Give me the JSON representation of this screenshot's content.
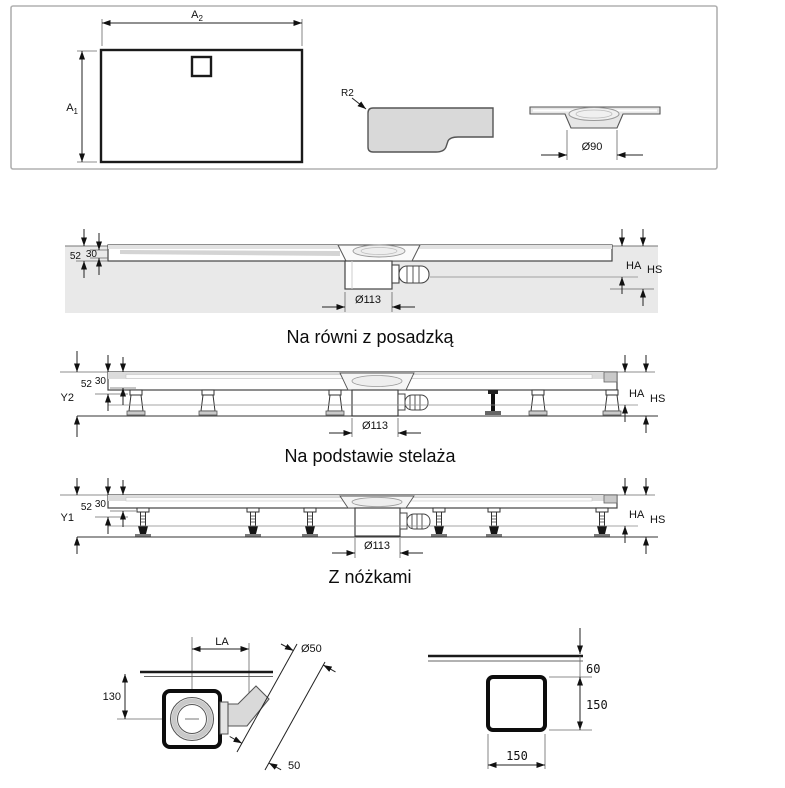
{
  "top": {
    "plan": {
      "w_base": "A",
      "w_sub": "2",
      "h_base": "A",
      "h_sub": "1"
    },
    "profile": {
      "r": "R2"
    },
    "drain": {
      "dia": "Ø90"
    }
  },
  "s1": {
    "title": "Na równi z posadzką",
    "d52": "52",
    "d30": "30",
    "ha": "HA",
    "hs": "HS",
    "dia": "Ø113"
  },
  "s2": {
    "title": "Na podstawie stelaża",
    "y": "Y2",
    "d52": "52",
    "d30": "30",
    "ha": "HA",
    "hs": "HS",
    "dia": "Ø113"
  },
  "s3": {
    "title": "Z nóżkami",
    "y": "Y1",
    "d52": "52",
    "d30": "30",
    "ha": "HA",
    "hs": "HS",
    "dia": "Ø113"
  },
  "detail_left": {
    "la": "LA",
    "dia": "Ø50",
    "height": "130",
    "stub": "50"
  },
  "detail_right": {
    "offset": "60",
    "height": "150",
    "width": "150"
  },
  "colors": {
    "line": "#333333",
    "profile_fill": "#d9d9d9",
    "floor_fill": "#e9e9e9",
    "panel_border": "#b0b0b0"
  }
}
